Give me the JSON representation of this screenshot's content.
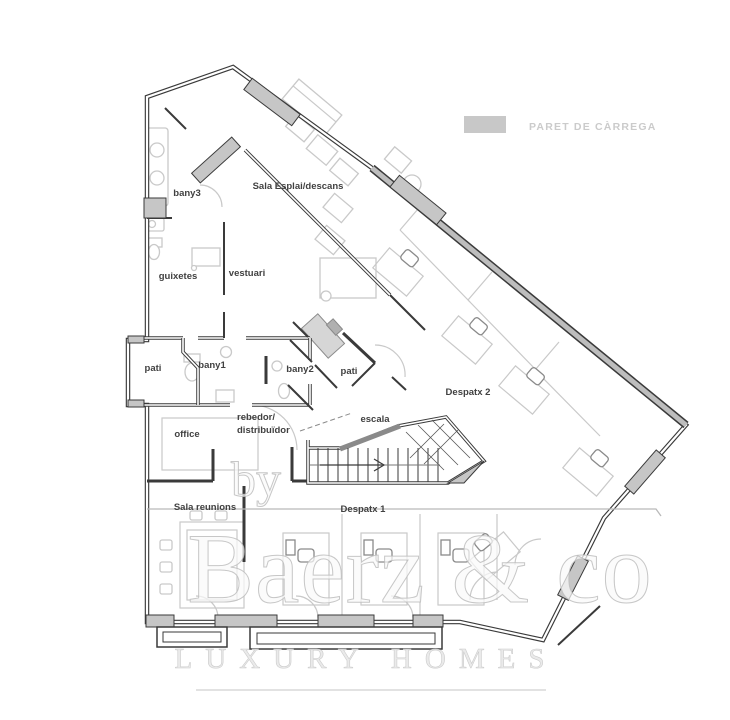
{
  "legend": {
    "swatch_color": "#c8c8c8",
    "label": "PARET DE CÀRREGA"
  },
  "rooms": {
    "bany3": "bany3",
    "sala_esplai": "Sala Esplai/descans",
    "guixetes": "guixetes",
    "vestuari": "vestuari",
    "pati_west": "pati",
    "bany1": "bany1",
    "bany2": "bany2",
    "pati_center": "pati",
    "rebedor_line1": "rebedor/",
    "rebedor_line2": "distribuïdor",
    "escala": "escala",
    "office": "office",
    "despatx2": "Despatx 2",
    "sala_reunions": "Sala reunions",
    "despatx1": "Despatx 1"
  },
  "watermark": {
    "prefix": "by",
    "brand": "Baerz & co",
    "tagline": "LUXURY HOMES"
  },
  "colors": {
    "wall": "#3a3a3a",
    "bearing_wall_fill": "#bdbdbd",
    "furniture": "#c9c9c9",
    "label_text": "#414141",
    "legend_text": "#cbcbcb",
    "watermark": "#d9d9d9"
  }
}
